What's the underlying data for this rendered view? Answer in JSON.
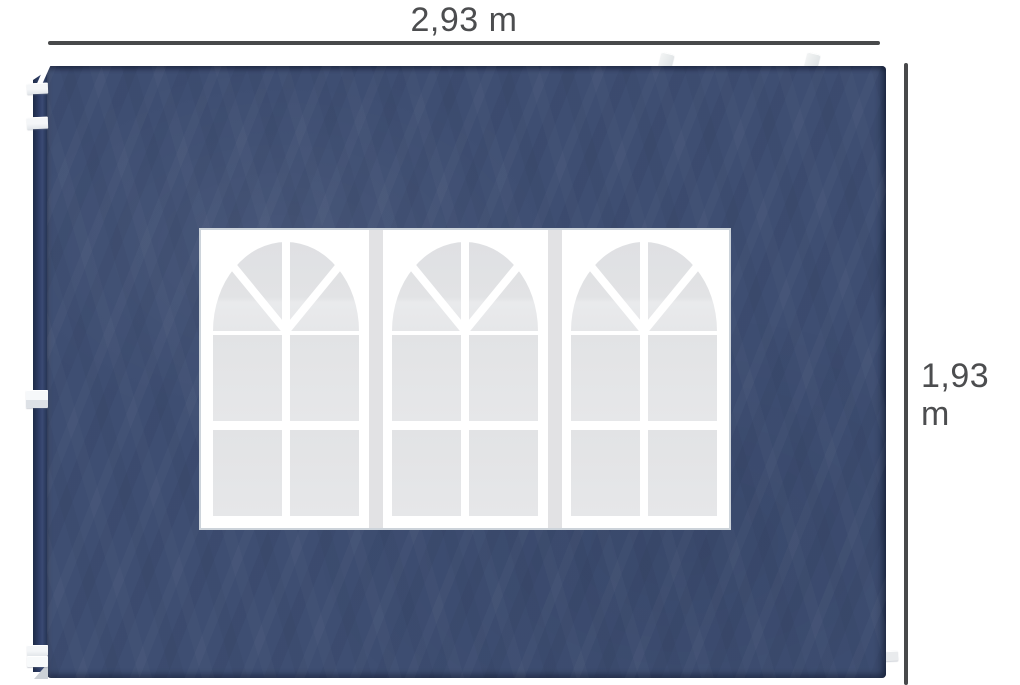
{
  "meta": {
    "description": "Product image of a navy blue gazebo replacement side wall panel with a three-section arched church-style window, annotated with width and height dimension lines",
    "background_color": "#ffffff"
  },
  "annotations": {
    "width_label": "2,93 m",
    "height_label": "1,93 m",
    "line_color": "#48494b",
    "label_color": "#4c4d4f"
  },
  "panel": {
    "fabric_color": "#3e4e72",
    "edge_fold_color": "#2a3857",
    "tab_color": "#f0f2f4",
    "tab_positions": [
      "left-edge-upper-1",
      "left-edge-upper-2",
      "left-edge-middle",
      "left-edge-bottom-1",
      "left-edge-bottom-2",
      "top-edge-left",
      "top-edge-right",
      "right-edge-bottom"
    ]
  },
  "window": {
    "units": 3,
    "frame_color": "#ffffff",
    "pane_color": "#e6e7e9",
    "divider_color": "#e2e2e4",
    "border_color": "#ccd3da",
    "fan_wedges_per_unit": 4,
    "rect_panes_per_unit": 4
  }
}
